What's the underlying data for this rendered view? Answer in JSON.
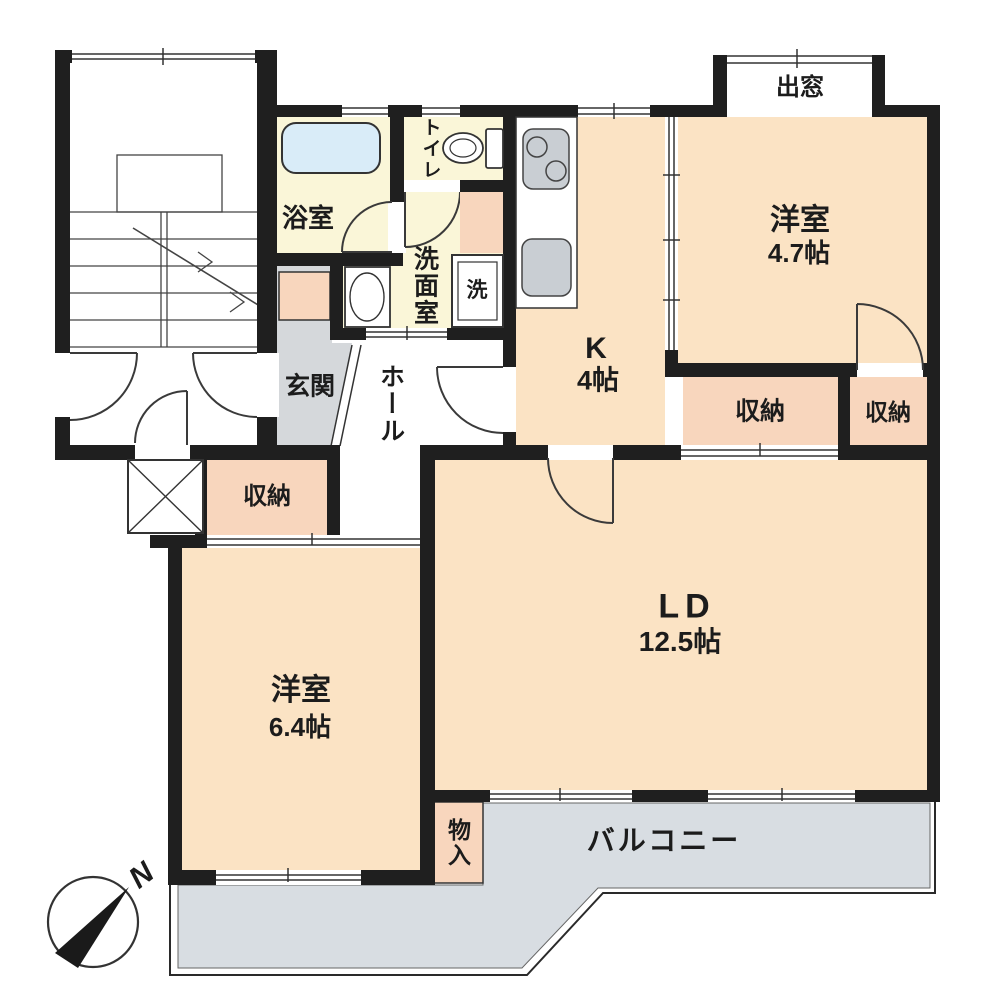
{
  "document": {
    "type": "apartment-floor-plan"
  },
  "rooms": {
    "bay_window": {
      "label": "出窓"
    },
    "western_room_1": {
      "name": "洋室",
      "size": "4.7帖"
    },
    "toilet": {
      "label": "トイレ"
    },
    "bath": {
      "label": "浴室"
    },
    "washroom": {
      "label": "洗面室"
    },
    "washer": {
      "label": "洗"
    },
    "kitchen": {
      "name": "K",
      "size": "4帖"
    },
    "entrance": {
      "label": "玄関"
    },
    "hall": {
      "label": "ホール"
    },
    "storage_entrance": {
      "label": "収納"
    },
    "storage_ld": {
      "label": "収納"
    },
    "storage_western1": {
      "label": "収納"
    },
    "western_room_2": {
      "name": "洋室",
      "size": "6.4帖"
    },
    "living_dining": {
      "name": "LD",
      "size": "12.5帖"
    },
    "storage_balcony": {
      "label": "物入"
    },
    "balcony": {
      "label": "バルコニー"
    }
  },
  "compass": {
    "north_label": "N"
  },
  "colors": {
    "wall": "#1f1f1f",
    "room_cream": "#fbe3c4",
    "wet_area_yellow": "#faf6d8",
    "storage_pink": "#f8d6bd",
    "balcony_gray": "#d8dde2",
    "entrance_gray": "#d5d8db",
    "tub_blue": "#d9ecf8",
    "fixture_gray": "#c9ced3"
  }
}
